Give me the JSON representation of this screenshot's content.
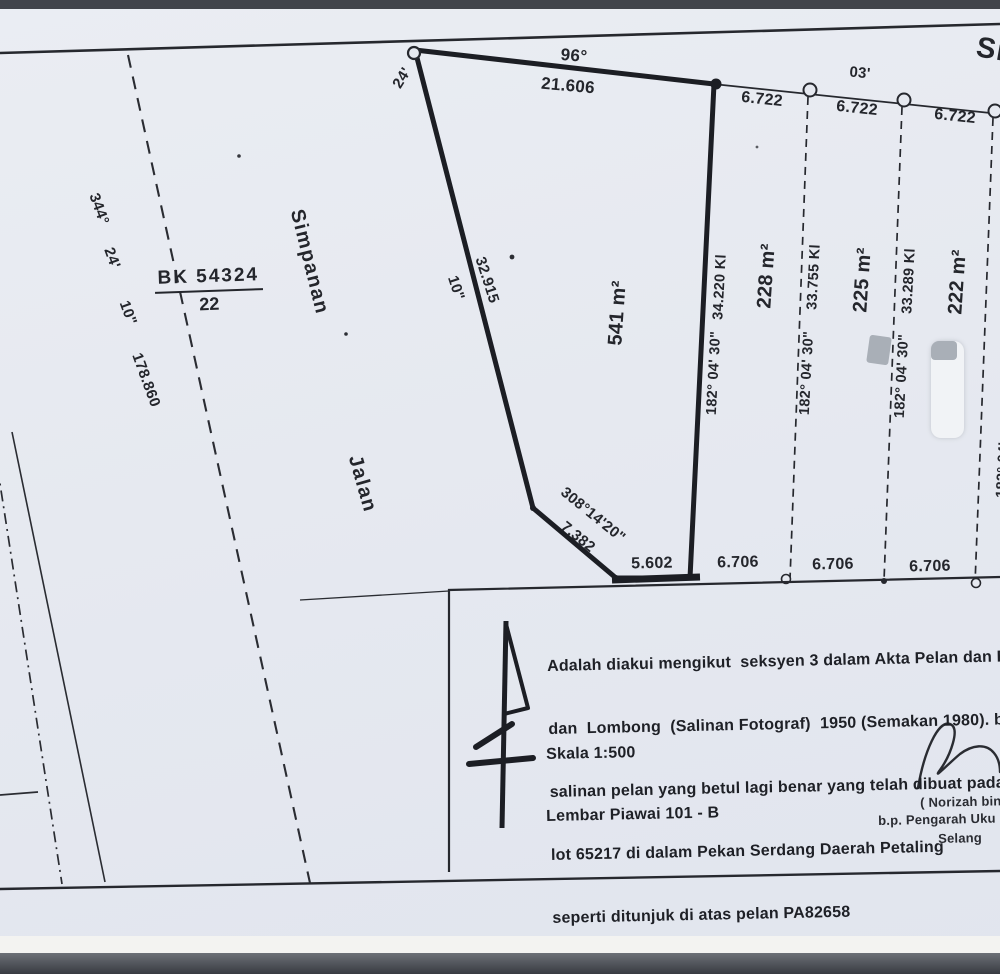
{
  "colors": {
    "paper": "#e6e9f0",
    "ink": "#24262c",
    "redaction_gray": "#a9afb7",
    "redaction_white": "#f1f3f6"
  },
  "top_boundary": {
    "bearing_deg": "96°",
    "bearing_min_left": "24'",
    "distance": "21.606",
    "right_bearing_min": "03'",
    "segment_distances": [
      "6.722",
      "6.722",
      "6.722"
    ],
    "road_label_partial": "Si"
  },
  "left_area": {
    "lot_ref_numerator": "BK 54324",
    "lot_ref_denominator": "22",
    "dashed_bearing_deg": "344°",
    "dashed_bearing_min": "24'",
    "dashed_bearing_sec": "10\"",
    "dashed_distance": "178.860",
    "road_label_reserve": "Simpanan",
    "road_label_road": "Jalan"
  },
  "main_parcel": {
    "area": "541 m²",
    "west_distance": "32.915",
    "west_bearing_sec": "10\"",
    "cut_corner_bearing": "308°14'20\"",
    "cut_corner_distance": "7.382",
    "bottom_distance": "5.602"
  },
  "dividers": [
    {
      "bearing": "182° 04' 30\"",
      "distance": "34.220 Kl"
    },
    {
      "bearing": "182° 04' 30\"",
      "distance": "33.755 Kl"
    },
    {
      "bearing": "182° 04' 30\"",
      "distance": "33.289 Kl"
    },
    {
      "bearing": "182° 04'",
      "distance": ""
    }
  ],
  "adjacent_parcels": [
    {
      "area": "228 m²",
      "bottom_distance": "6.706"
    },
    {
      "area": "225 m²",
      "bottom_distance": "6.706"
    },
    {
      "area": "222 m²",
      "bottom_distance": "6.706"
    }
  ],
  "info_box": {
    "statement_lines": [
      "Adalah diakui mengikut  seksyen 3 dalam Akta Pelan dan Do",
      "dan  Lombong  (Salinan Fotograf)  1950 (Semakan 1980). b",
      "salinan pelan yang betul lagi benar yang telah dibuat pada 25",
      "lot 65217 di dalam Pekan Serdang Daerah Petaling",
      "seperti ditunjuk di atas pelan PA82658"
    ],
    "scale_label": "Skala 1:500",
    "sheet_label": "Lembar Piawai 101 - B",
    "signatory_name": "( Norizah bin",
    "signatory_title": "b.p. Pengarah Uku",
    "signatory_region": "Selang"
  }
}
